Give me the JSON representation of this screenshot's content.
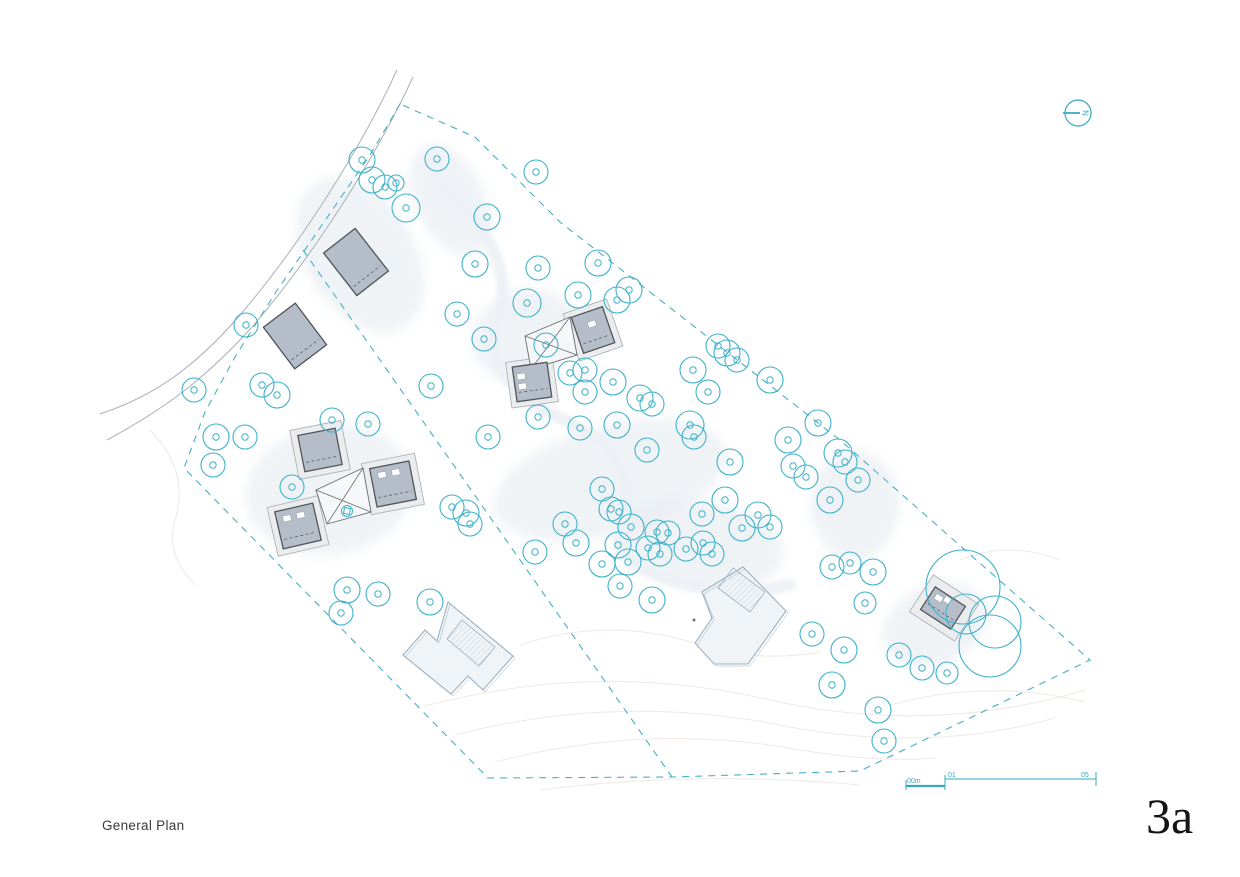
{
  "title_block": {
    "drawing_title": "General Plan",
    "sheet_number": "3a"
  },
  "north_arrow": {
    "label": "N"
  },
  "scale_bar": {
    "start_label": "00m",
    "mid_label": "01",
    "end_label": "05"
  },
  "colors": {
    "tree": "#3db2cb",
    "boundary": "#49afc2",
    "annotation": "#35a8c2",
    "road": "#a9b0b6",
    "building_fill": "#b4bdc8",
    "building_stroke": "#50555b",
    "platform_fill": "#eaecee",
    "platform_stroke": "#a6acb2",
    "court_stroke": "#676d73",
    "lhouse_fill": "#f1f4f7",
    "lhouse_stroke": "#9cb0c0",
    "hatch": "#bdd2de",
    "contour": "#f0e8e3",
    "shadow": "#e8edf2",
    "stream": "#edf1f5"
  },
  "site": {
    "road_edges": [
      "M397,70 C360,150 300,245 240,315 C190,373 148,398 100,414",
      "M413,77 C376,157 314,255 252,327 C200,385 155,414 107,440"
    ],
    "boundary": [
      [
        400,
        104
      ],
      [
        370,
        155
      ],
      [
        322,
        225
      ],
      [
        276,
        292
      ],
      [
        235,
        357
      ],
      [
        205,
        412
      ],
      [
        184,
        468
      ],
      [
        488,
        778
      ],
      [
        672,
        777
      ],
      [
        860,
        771
      ],
      [
        1090,
        660
      ],
      [
        840,
        440
      ],
      [
        560,
        222
      ],
      [
        475,
        137
      ],
      [
        400,
        104
      ]
    ],
    "interior_boundary": [
      [
        303,
        250
      ],
      [
        672,
        777
      ]
    ],
    "contours": [
      "M425,706 Q600,660 770,700 Q930,736 1085,690",
      "M455,735 Q620,692 790,727 Q930,753 1055,718",
      "M495,762 Q650,722 800,750 Q880,763 935,758",
      "M520,645 Q610,615 700,645 Q760,663 820,652",
      "M890,705 Q990,678 1085,702",
      "M150,430 Q190,470 175,520 Q165,555 195,585",
      "M540,790 Q700,770 860,785",
      "M960,560 Q1010,540 1060,560"
    ],
    "stream": [
      "M440,185 Q520,255 498,318 Q478,378 560,418 Q645,458 622,520 Q605,562 680,582 Q740,598 790,585"
    ],
    "shadows": [
      {
        "cx": 360,
        "cy": 255,
        "rx": 55,
        "ry": 85,
        "rot": -32
      },
      {
        "cx": 330,
        "cy": 490,
        "rx": 85,
        "ry": 65,
        "rot": -10
      },
      {
        "cx": 610,
        "cy": 480,
        "rx": 120,
        "ry": 55,
        "rot": -15
      },
      {
        "cx": 700,
        "cy": 545,
        "rx": 85,
        "ry": 45,
        "rot": 8
      },
      {
        "cx": 855,
        "cy": 505,
        "rx": 45,
        "ry": 55,
        "rot": 0
      },
      {
        "cx": 935,
        "cy": 625,
        "rx": 55,
        "ry": 40,
        "rot": -25
      },
      {
        "cx": 525,
        "cy": 335,
        "rx": 55,
        "ry": 45,
        "rot": -20
      },
      {
        "cx": 450,
        "cy": 200,
        "rx": 35,
        "ry": 60,
        "rot": -25
      }
    ],
    "platforms": [
      {
        "cx": 320,
        "cy": 450,
        "w": 52,
        "h": 50,
        "rot": -11
      },
      {
        "cx": 393,
        "cy": 484,
        "w": 54,
        "h": 52,
        "rot": -11
      },
      {
        "cx": 298,
        "cy": 526,
        "w": 52,
        "h": 50,
        "rot": -13
      },
      {
        "cx": 593,
        "cy": 330,
        "w": 46,
        "h": 50,
        "rot": -19
      },
      {
        "cx": 532,
        "cy": 382,
        "w": 47,
        "h": 46,
        "rot": -8
      },
      {
        "cx": 944,
        "cy": 608,
        "w": 54,
        "h": 44,
        "rot": 33
      }
    ],
    "courtyards": [
      {
        "points": [
          [
            316,
            490
          ],
          [
            363,
            468
          ],
          [
            371,
            512
          ],
          [
            327,
            524
          ]
        ]
      },
      {
        "points": [
          [
            525,
            336
          ],
          [
            570,
            317
          ],
          [
            577,
            355
          ],
          [
            531,
            369
          ]
        ]
      }
    ],
    "buildings": [
      {
        "cx": 356,
        "cy": 262,
        "w": 40,
        "h": 54,
        "rot": -38,
        "windows": []
      },
      {
        "cx": 295,
        "cy": 336,
        "w": 40,
        "h": 52,
        "rot": -37,
        "windows": []
      },
      {
        "cx": 320,
        "cy": 450,
        "w": 38,
        "h": 37,
        "rot": -11,
        "windows": []
      },
      {
        "cx": 393,
        "cy": 484,
        "w": 40,
        "h": 39,
        "rot": -11,
        "windows": [
          [
            -13,
            -14
          ],
          [
            1,
            -14
          ]
        ]
      },
      {
        "cx": 298,
        "cy": 526,
        "w": 39,
        "h": 38,
        "rot": -13,
        "windows": [
          [
            -13,
            -13
          ],
          [
            1,
            -13
          ]
        ]
      },
      {
        "cx": 593,
        "cy": 330,
        "w": 33,
        "h": 38,
        "rot": -19,
        "windows": [
          [
            -3,
            -9
          ]
        ]
      },
      {
        "cx": 532,
        "cy": 382,
        "w": 35,
        "h": 35,
        "rot": -8,
        "windows": [
          [
            -14,
            -10
          ],
          [
            -14,
            0
          ]
        ]
      },
      {
        "cx": 943,
        "cy": 608,
        "w": 36,
        "h": 27,
        "rot": 33,
        "windows": [
          [
            -13,
            -9
          ],
          [
            -4,
            -12
          ]
        ]
      }
    ],
    "l_houses": [
      {
        "outline": [
          [
            448,
            602
          ],
          [
            513,
            656
          ],
          [
            483,
            690
          ],
          [
            468,
            676
          ],
          [
            451,
            694
          ],
          [
            403,
            655
          ],
          [
            425,
            630
          ],
          [
            437,
            641
          ]
        ],
        "hatch": [
          [
            462,
            620
          ],
          [
            495,
            647
          ],
          [
            479,
            666
          ],
          [
            447,
            639
          ]
        ]
      },
      {
        "outline": [
          [
            743,
            567
          ],
          [
            786,
            611
          ],
          [
            748,
            664
          ],
          [
            714,
            664
          ],
          [
            695,
            643
          ],
          [
            712,
            618
          ],
          [
            702,
            592
          ]
        ],
        "hatch": [
          [
            733,
            568
          ],
          [
            765,
            592
          ],
          [
            750,
            612
          ],
          [
            718,
            588
          ]
        ]
      }
    ],
    "markers": {
      "flower": [
        347,
        511
      ],
      "dot": [
        694,
        620
      ]
    },
    "trees": [
      [
        362,
        160,
        13
      ],
      [
        372,
        180,
        13
      ],
      [
        385,
        187,
        12
      ],
      [
        396,
        183,
        8
      ],
      [
        406,
        208,
        14
      ],
      [
        437,
        159,
        12
      ],
      [
        536,
        172,
        12
      ],
      [
        487,
        217,
        13
      ],
      [
        475,
        264,
        13
      ],
      [
        538,
        268,
        12
      ],
      [
        598,
        263,
        13
      ],
      [
        629,
        290,
        13
      ],
      [
        578,
        295,
        13
      ],
      [
        617,
        300,
        13
      ],
      [
        246,
        325,
        12
      ],
      [
        194,
        390,
        12
      ],
      [
        262,
        385,
        12
      ],
      [
        277,
        395,
        13
      ],
      [
        216,
        437,
        13
      ],
      [
        245,
        437,
        12
      ],
      [
        213,
        465,
        12
      ],
      [
        292,
        487,
        12
      ],
      [
        332,
        420,
        12
      ],
      [
        368,
        424,
        12
      ],
      [
        431,
        386,
        12
      ],
      [
        457,
        314,
        12
      ],
      [
        484,
        339,
        12
      ],
      [
        488,
        437,
        12
      ],
      [
        452,
        507,
        12
      ],
      [
        466,
        513,
        13
      ],
      [
        470,
        524,
        12
      ],
      [
        527,
        303,
        14
      ],
      [
        546,
        345,
        12
      ],
      [
        585,
        392,
        12
      ],
      [
        613,
        382,
        13
      ],
      [
        538,
        417,
        12
      ],
      [
        570,
        373,
        12
      ],
      [
        585,
        370,
        12
      ],
      [
        640,
        398,
        13
      ],
      [
        652,
        404,
        12
      ],
      [
        693,
        370,
        13
      ],
      [
        708,
        392,
        12
      ],
      [
        727,
        353,
        13
      ],
      [
        737,
        360,
        12
      ],
      [
        718,
        346,
        12
      ],
      [
        770,
        380,
        13
      ],
      [
        580,
        428,
        12
      ],
      [
        617,
        425,
        13
      ],
      [
        647,
        450,
        12
      ],
      [
        690,
        425,
        14
      ],
      [
        694,
        437,
        12
      ],
      [
        730,
        462,
        13
      ],
      [
        788,
        440,
        13
      ],
      [
        818,
        423,
        13
      ],
      [
        838,
        453,
        14
      ],
      [
        845,
        462,
        12
      ],
      [
        602,
        489,
        12
      ],
      [
        611,
        509,
        12
      ],
      [
        619,
        512,
        12
      ],
      [
        631,
        527,
        13
      ],
      [
        576,
        543,
        13
      ],
      [
        618,
        545,
        13
      ],
      [
        657,
        532,
        12
      ],
      [
        668,
        533,
        12
      ],
      [
        648,
        548,
        12
      ],
      [
        628,
        562,
        13
      ],
      [
        602,
        564,
        13
      ],
      [
        660,
        554,
        12
      ],
      [
        686,
        549,
        12
      ],
      [
        703,
        543,
        12
      ],
      [
        712,
        554,
        12
      ],
      [
        742,
        528,
        13
      ],
      [
        758,
        515,
        13
      ],
      [
        770,
        527,
        12
      ],
      [
        702,
        514,
        12
      ],
      [
        725,
        500,
        13
      ],
      [
        652,
        600,
        13
      ],
      [
        620,
        586,
        12
      ],
      [
        565,
        524,
        12
      ],
      [
        535,
        552,
        12
      ],
      [
        793,
        466,
        12
      ],
      [
        806,
        477,
        12
      ],
      [
        830,
        500,
        13
      ],
      [
        858,
        480,
        12
      ],
      [
        832,
        567,
        12
      ],
      [
        850,
        563,
        11
      ],
      [
        873,
        572,
        13
      ],
      [
        865,
        603,
        11
      ],
      [
        812,
        634,
        12
      ],
      [
        844,
        650,
        13
      ],
      [
        832,
        685,
        13
      ],
      [
        878,
        710,
        13
      ],
      [
        884,
        741,
        12
      ],
      [
        899,
        655,
        12
      ],
      [
        922,
        668,
        12
      ],
      [
        947,
        673,
        11
      ],
      [
        963,
        587,
        37
      ],
      [
        995,
        622,
        26
      ],
      [
        990,
        646,
        31
      ],
      [
        966,
        614,
        20
      ],
      [
        347,
        590,
        13
      ],
      [
        378,
        594,
        12
      ],
      [
        341,
        613,
        12
      ],
      [
        430,
        602,
        13
      ]
    ]
  }
}
